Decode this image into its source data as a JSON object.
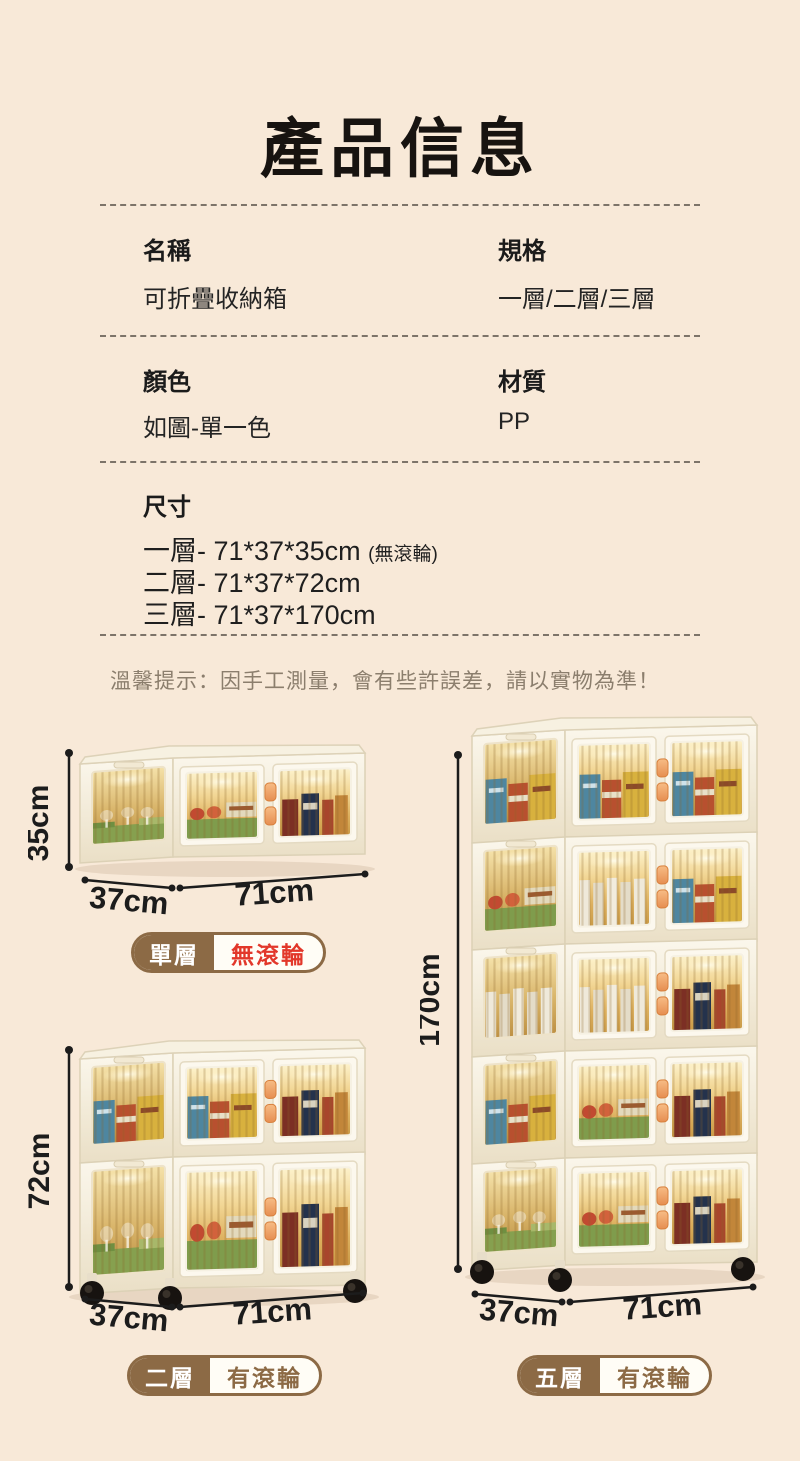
{
  "header": {
    "title": "產品信息"
  },
  "info": {
    "name_label": "名稱",
    "name_value": "可折疊收納箱",
    "spec_label": "規格",
    "spec_value": "一層/二層/三層",
    "color_label": "顏色",
    "color_value": "如圖-單一色",
    "material_label": "材質",
    "material_value": "PP",
    "size_label": "尺寸",
    "size_line1": "一層- 71*37*35cm",
    "size_line1_note": "(無滾輪)",
    "size_line2": "二層- 71*37*72cm",
    "size_line3": "三層- 71*37*170cm"
  },
  "tip": "溫馨提示：因手工測量，會有些許誤差，請以實物為準！",
  "figures": {
    "single": {
      "height": "35cm",
      "depth": "37cm",
      "width": "71cm",
      "tier": "單層",
      "wheels": "無滾輪",
      "wheels_style": "color:#e2372a"
    },
    "double": {
      "height": "72cm",
      "depth": "37cm",
      "width": "71cm",
      "tier": "二層",
      "wheels": "有滾輪",
      "wheels_style": "color:#8c6a45"
    },
    "five": {
      "height": "170cm",
      "depth": "37cm",
      "width": "71cm",
      "tier": "五層",
      "wheels": "有滾輪",
      "wheels_style": "color:#8c6a45"
    }
  },
  "colors": {
    "background": "#f8e9d8",
    "badge_brown": "#8c6a45",
    "badge_red": "#e2372a",
    "box_cream": "#f4eddc",
    "window_amber": "#e0b45f",
    "handle_orange": "#ef9f62",
    "wheel_black": "#171310"
  }
}
